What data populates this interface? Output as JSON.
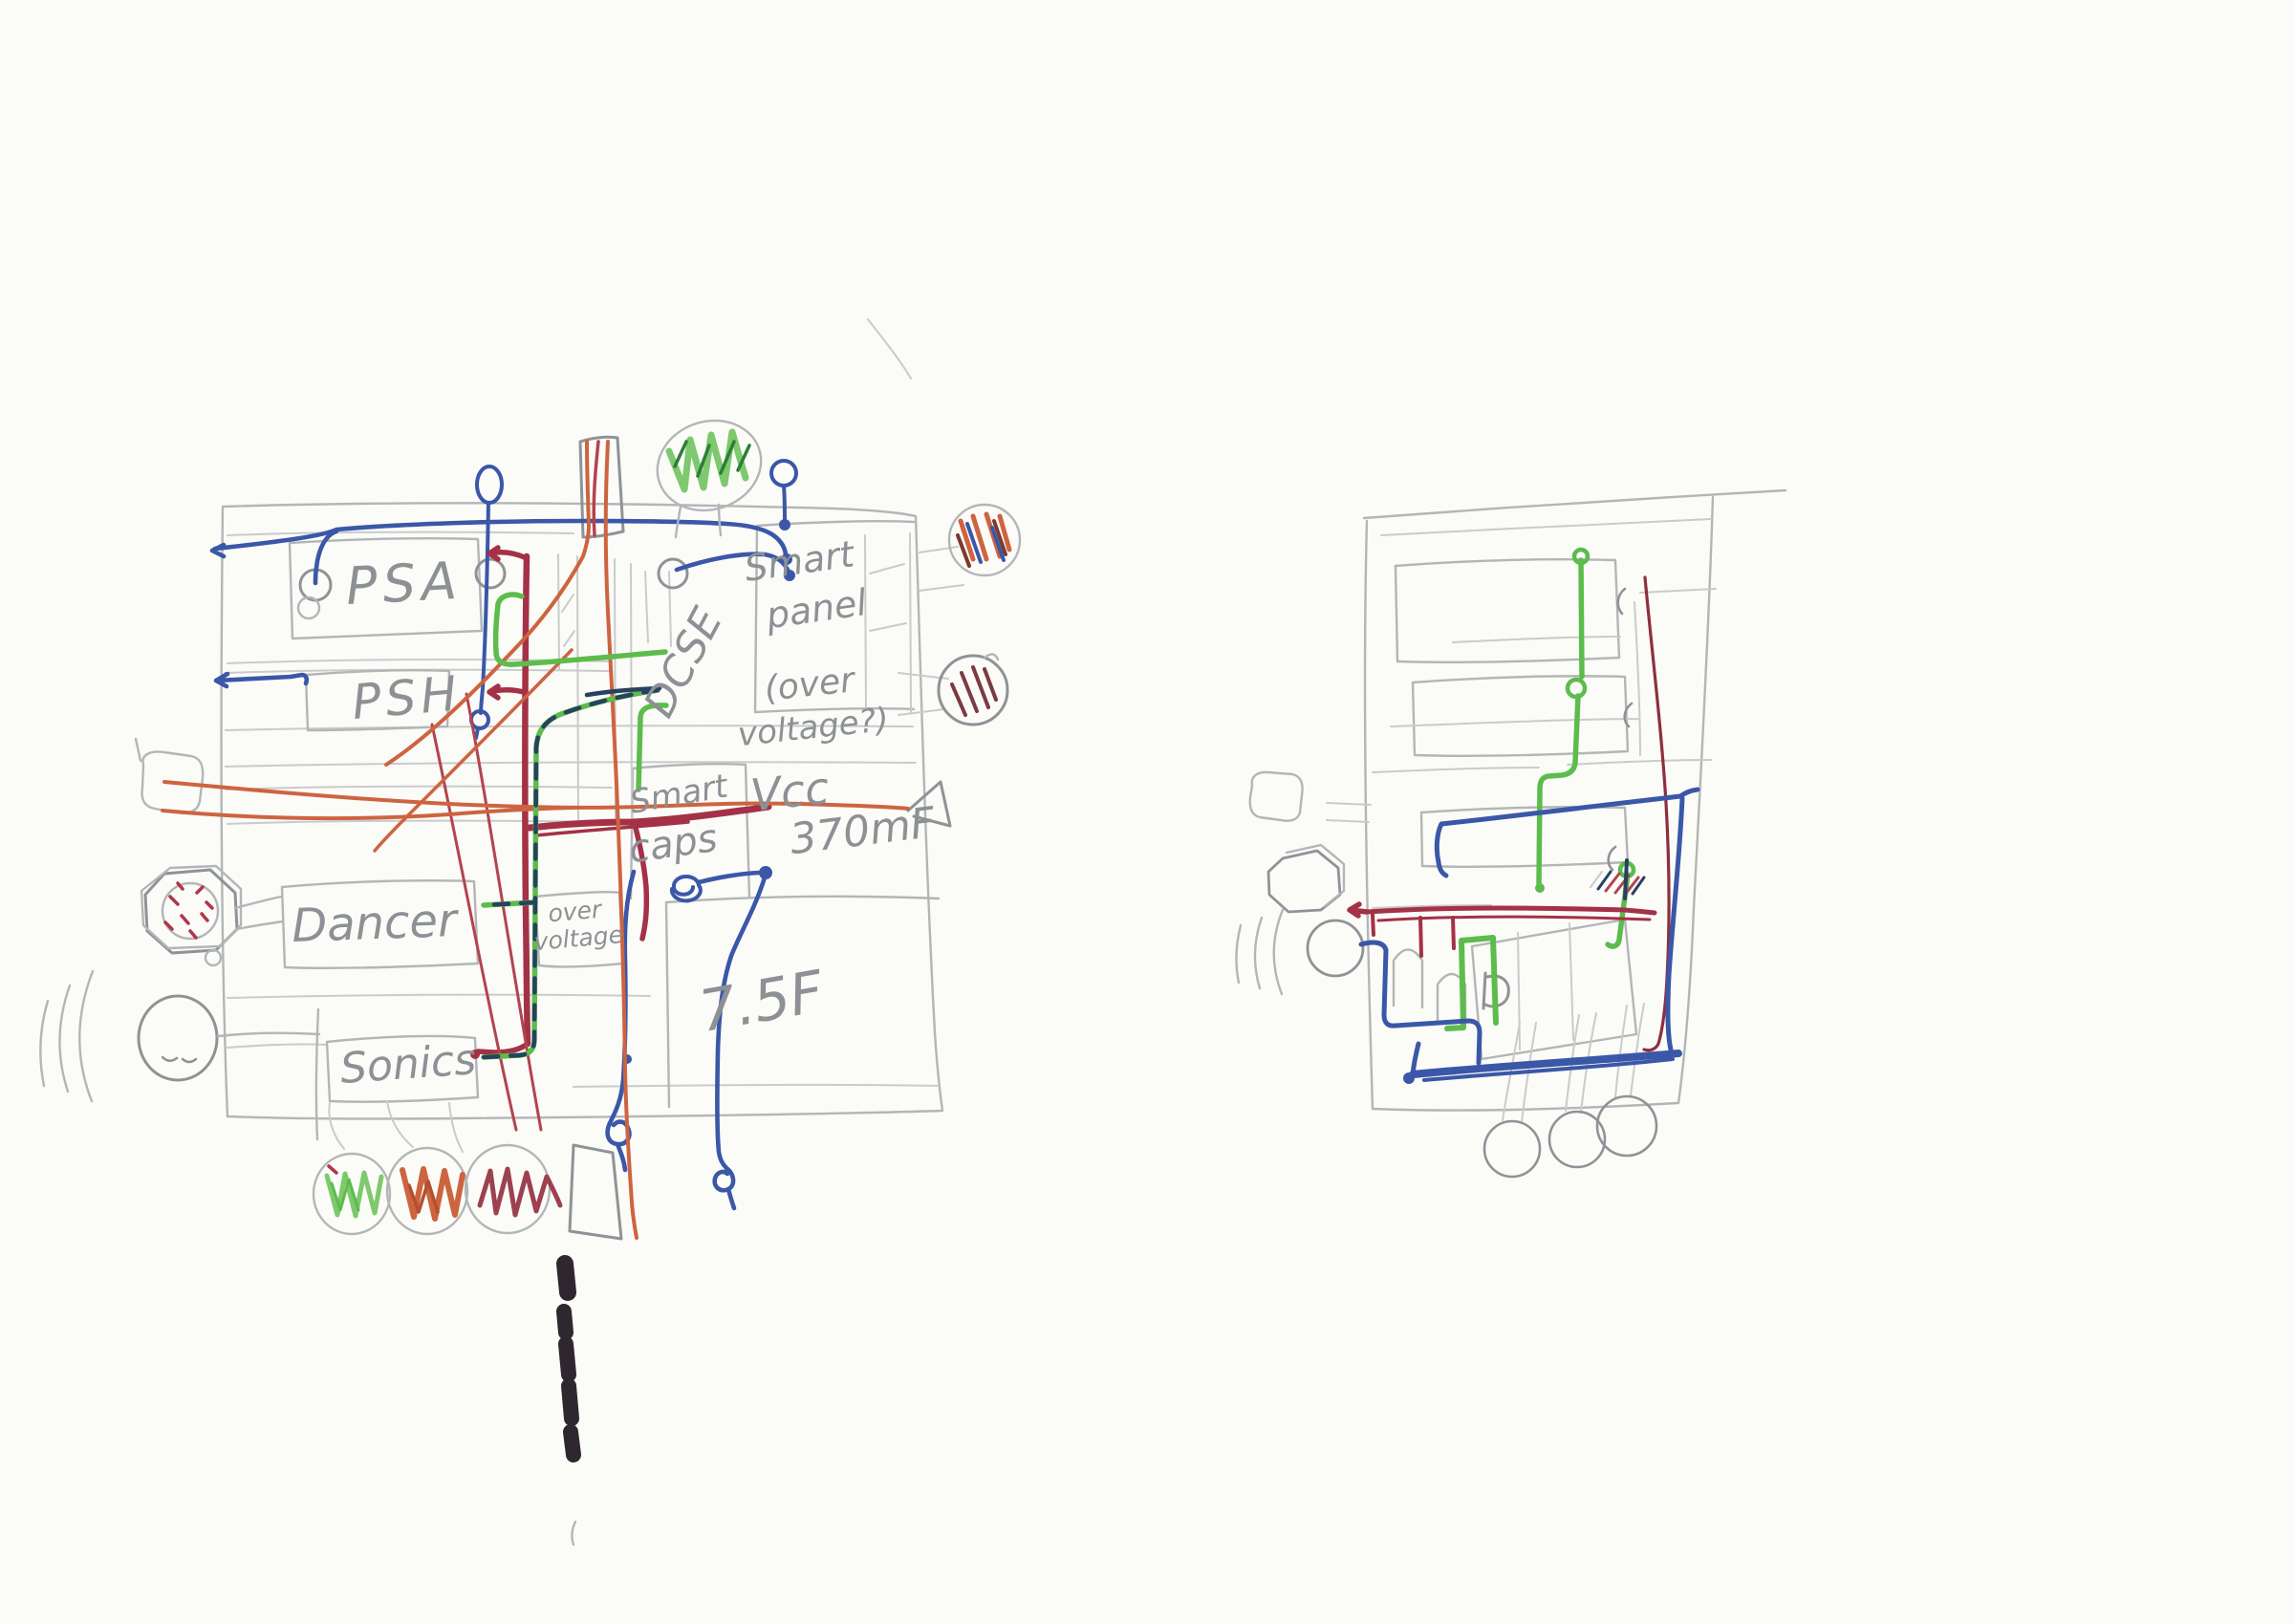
{
  "page": {
    "background": "#fbfbf8"
  },
  "colors": {
    "blue_wire": "#3a57a8",
    "dark_red_wire": "#a43145",
    "orange_wire": "#cd6440",
    "green_wire": "#5cbc4c",
    "navy_dash": "#27425f",
    "maroon_wire": "#8e2f3e",
    "pencil": "#b3b6b8",
    "marker_black": "#2e2730",
    "red_marks": "#b03648"
  },
  "left": {
    "psa": "PSA",
    "psh": "PSH",
    "dcse": "DCSE",
    "smart_panel": [
      "Smart",
      "panel"
    ],
    "over_voltage_question": [
      "(over",
      "voltage?)"
    ],
    "smart_caps": [
      "Smart",
      "caps"
    ],
    "vcc": "Vcc",
    "cap_value": "370mF",
    "dancer": "Dancer",
    "over_voltage_box": [
      "over",
      "voltage"
    ],
    "sonics": "Sonics",
    "big_cap": "7.5F"
  }
}
